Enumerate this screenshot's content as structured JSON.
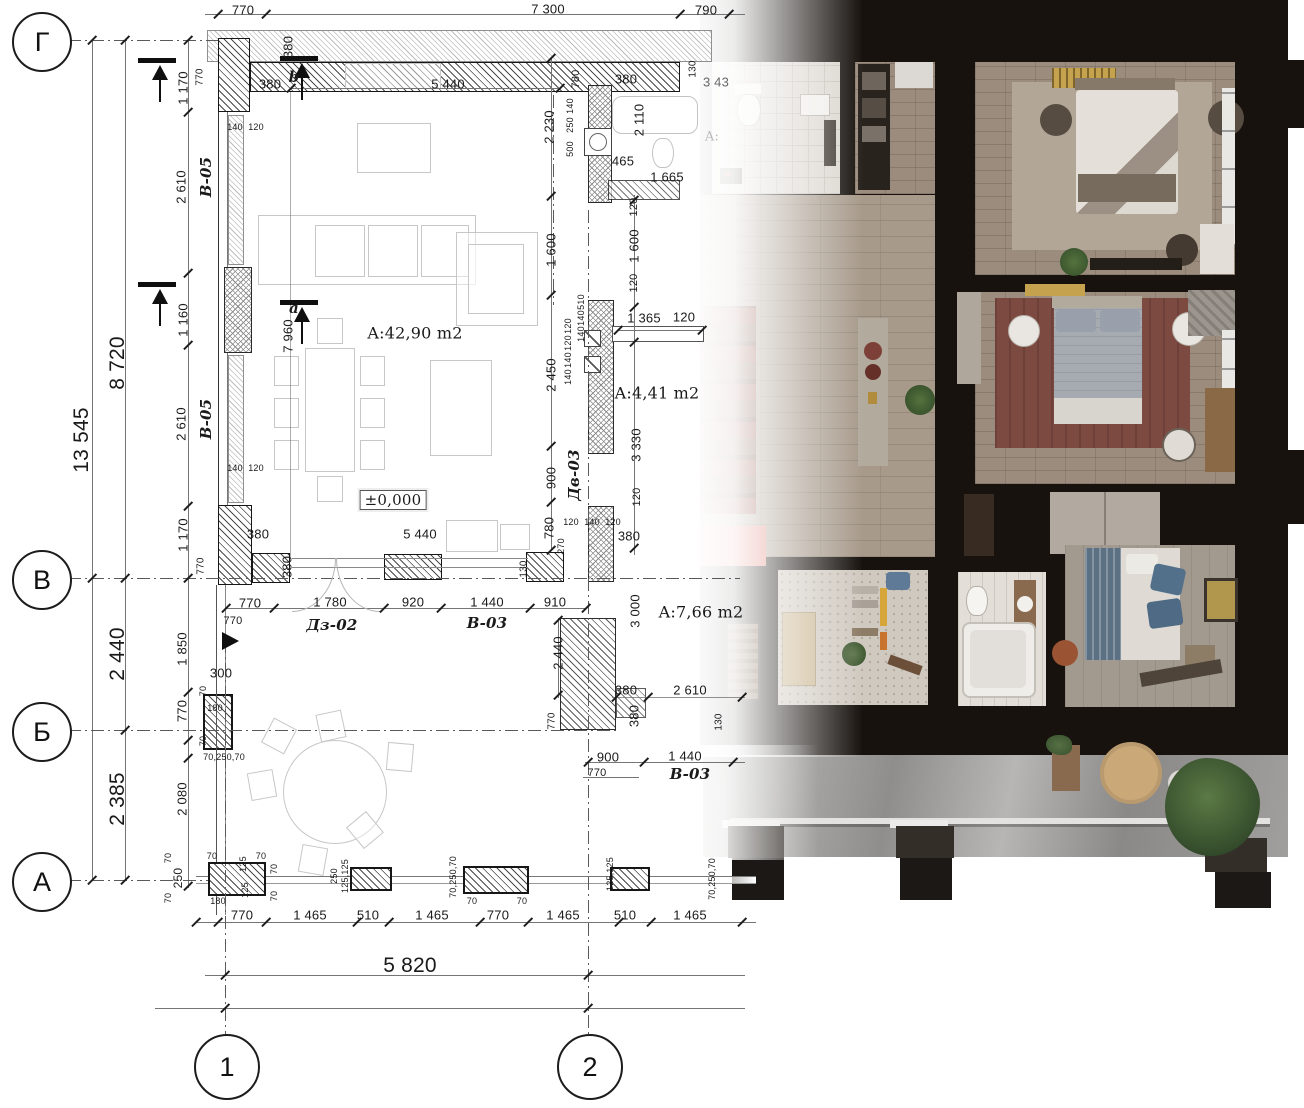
{
  "axes": {
    "rows": [
      {
        "label": "Г"
      },
      {
        "label": "В"
      },
      {
        "label": "Б"
      },
      {
        "label": "А"
      }
    ],
    "cols": [
      {
        "label": "1"
      },
      {
        "label": "2"
      }
    ]
  },
  "palette": {
    "wall_black": "#17120e",
    "wood_floor": "#9b8c7d",
    "hall_floor": "#a79a8b",
    "rug_red": "#7c4a41",
    "cabinet_red": "#df857b",
    "bed_blue": "#5c7083",
    "tile_white": "#dbd6cf",
    "terrace_concrete": "#97968f",
    "gold": "#c5a24d"
  },
  "dims": [
    {
      "t": "770",
      "x": 243,
      "y": 10
    },
    {
      "t": "7 300",
      "x": 548,
      "y": 9
    },
    {
      "t": "790",
      "x": 706,
      "y": 10
    },
    {
      "t": "770",
      "x": 200,
      "y": 77,
      "r": -90,
      "s": 10
    },
    {
      "t": "1 170",
      "x": 183,
      "y": 88,
      "r": -90
    },
    {
      "t": "380",
      "x": 270,
      "y": 84
    },
    {
      "t": "b",
      "x": 294,
      "y": 77,
      "c": "tag",
      "n": "section-mark-b"
    },
    {
      "t": "380",
      "x": 288,
      "y": 47,
      "r": -90
    },
    {
      "t": "5 440",
      "x": 448,
      "y": 84
    },
    {
      "t": "780",
      "x": 576,
      "y": 79,
      "r": -90,
      "s": 11
    },
    {
      "t": "2 230",
      "x": 549,
      "y": 127,
      "r": -90
    },
    {
      "t": "140",
      "x": 570,
      "y": 106,
      "r": -90,
      "s": 9
    },
    {
      "t": "250",
      "x": 570,
      "y": 125,
      "r": -90,
      "s": 9
    },
    {
      "t": "500",
      "x": 570,
      "y": 149,
      "r": -90,
      "s": 9
    },
    {
      "t": "380",
      "x": 626,
      "y": 79
    },
    {
      "t": "2 110",
      "x": 639,
      "y": 120,
      "r": -90
    },
    {
      "t": "130",
      "x": 693,
      "y": 69,
      "r": -90,
      "s": 10
    },
    {
      "t": "3 43",
      "x": 716,
      "y": 82,
      "c": "fade"
    },
    {
      "t": "465",
      "x": 623,
      "y": 161
    },
    {
      "t": "1 665",
      "x": 667,
      "y": 177
    },
    {
      "t": "120",
      "x": 634,
      "y": 207,
      "r": -90,
      "s": 11
    },
    {
      "t": "1 600",
      "x": 634,
      "y": 246,
      "r": -90
    },
    {
      "t": "1 600",
      "x": 551,
      "y": 250,
      "r": -90
    },
    {
      "t": "120",
      "x": 634,
      "y": 283,
      "r": -90,
      "s": 11
    },
    {
      "t": "A:",
      "x": 712,
      "y": 137,
      "c": "faint"
    },
    {
      "t": "13 545",
      "x": 82,
      "y": 440,
      "r": -90,
      "c": "big"
    },
    {
      "t": "8 720",
      "x": 118,
      "y": 363,
      "r": -90,
      "c": "big"
    },
    {
      "t": "2 440",
      "x": 118,
      "y": 654,
      "r": -90,
      "c": "big"
    },
    {
      "t": "2 385",
      "x": 118,
      "y": 799,
      "r": -90,
      "c": "big"
    },
    {
      "t": "2 610",
      "x": 181,
      "y": 187,
      "r": -90
    },
    {
      "t": "В-05",
      "x": 206,
      "y": 177,
      "r": -90,
      "c": "tag",
      "n": "tag-window-v05"
    },
    {
      "t": "140",
      "x": 235,
      "y": 127,
      "s": 9
    },
    {
      "t": "120",
      "x": 256,
      "y": 127,
      "s": 9
    },
    {
      "t": "1 160",
      "x": 183,
      "y": 320,
      "r": -90
    },
    {
      "t": "2 610",
      "x": 181,
      "y": 424,
      "r": -90
    },
    {
      "t": "В-05",
      "x": 206,
      "y": 419,
      "r": -90,
      "c": "tag",
      "n": "tag-window-v05"
    },
    {
      "t": "140",
      "x": 235,
      "y": 468,
      "s": 9
    },
    {
      "t": "120",
      "x": 256,
      "y": 468,
      "s": 9
    },
    {
      "t": "1 170",
      "x": 183,
      "y": 535,
      "r": -90
    },
    {
      "t": "770",
      "x": 201,
      "y": 566,
      "r": -90,
      "s": 10
    },
    {
      "t": "a",
      "x": 294,
      "y": 308,
      "c": "tag",
      "n": "section-mark-a"
    },
    {
      "t": "7 960",
      "x": 288,
      "y": 336,
      "r": -90
    },
    {
      "t": "A:42,90 m2",
      "x": 415,
      "y": 333,
      "c": "area",
      "n": "room-area-living"
    },
    {
      "t": "±0,000",
      "x": 393,
      "y": 500,
      "c": "box",
      "n": "level-mark"
    },
    {
      "t": "510",
      "x": 581,
      "y": 302,
      "r": -90,
      "s": 9
    },
    {
      "t": "140",
      "x": 581,
      "y": 318,
      "r": -90,
      "s": 9
    },
    {
      "t": "140",
      "x": 581,
      "y": 334,
      "r": -90,
      "s": 9
    },
    {
      "t": "120",
      "x": 568,
      "y": 326,
      "r": -90,
      "s": 9
    },
    {
      "t": "120",
      "x": 568,
      "y": 343,
      "r": -90,
      "s": 9
    },
    {
      "t": "140",
      "x": 568,
      "y": 360,
      "r": -90,
      "s": 9
    },
    {
      "t": "140",
      "x": 568,
      "y": 377,
      "r": -90,
      "s": 9
    },
    {
      "t": "1 365",
      "x": 644,
      "y": 318
    },
    {
      "t": "120",
      "x": 684,
      "y": 317
    },
    {
      "t": "2 450",
      "x": 551,
      "y": 375,
      "r": -90
    },
    {
      "t": "A:4,41 m2",
      "x": 657,
      "y": 393,
      "c": "area",
      "n": "room-area-kitchen"
    },
    {
      "t": "3 330",
      "x": 636,
      "y": 445,
      "r": -90
    },
    {
      "t": "900",
      "x": 551,
      "y": 478,
      "r": -90
    },
    {
      "t": "Дв-03",
      "x": 574,
      "y": 475,
      "r": -90,
      "c": "tag",
      "n": "tag-door-dv03"
    },
    {
      "t": "780",
      "x": 549,
      "y": 528,
      "r": -90
    },
    {
      "t": "120",
      "x": 571,
      "y": 522,
      "s": 9
    },
    {
      "t": "140",
      "x": 592,
      "y": 522,
      "s": 9
    },
    {
      "t": "120",
      "x": 613,
      "y": 522,
      "s": 9
    },
    {
      "t": "380",
      "x": 629,
      "y": 536
    },
    {
      "t": "270",
      "x": 561,
      "y": 546,
      "r": -90,
      "s": 9
    },
    {
      "t": "120",
      "x": 637,
      "y": 497,
      "r": -90,
      "s": 11
    },
    {
      "t": "3 000",
      "x": 635,
      "y": 611,
      "r": -90
    },
    {
      "t": "A:7,66 m2",
      "x": 701,
      "y": 612,
      "c": "area",
      "n": "room-area-hall"
    },
    {
      "t": "380",
      "x": 258,
      "y": 534
    },
    {
      "t": "5 440",
      "x": 420,
      "y": 534
    },
    {
      "t": "380",
      "x": 287,
      "y": 567,
      "r": -90
    },
    {
      "t": "130",
      "x": 524,
      "y": 569,
      "r": -90,
      "s": 10
    },
    {
      "t": "770",
      "x": 250,
      "y": 603
    },
    {
      "t": "1 780",
      "x": 330,
      "y": 602
    },
    {
      "t": "920",
      "x": 413,
      "y": 602
    },
    {
      "t": "1 440",
      "x": 487,
      "y": 602
    },
    {
      "t": "910",
      "x": 555,
      "y": 602
    },
    {
      "t": "770",
      "x": 233,
      "y": 621,
      "s": 11
    },
    {
      "t": "Дз-02",
      "x": 332,
      "y": 625,
      "c": "tag",
      "n": "tag-door-dz02"
    },
    {
      "t": "В-03",
      "x": 487,
      "y": 623,
      "c": "tag",
      "n": "tag-window-v03"
    },
    {
      "t": "2 440",
      "x": 558,
      "y": 653,
      "r": -90
    },
    {
      "t": "1 850",
      "x": 182,
      "y": 649,
      "r": -90
    },
    {
      "t": "300",
      "x": 221,
      "y": 673
    },
    {
      "t": "70",
      "x": 203,
      "y": 691,
      "r": -90,
      "s": 9
    },
    {
      "t": "180",
      "x": 215,
      "y": 708,
      "s": 9
    },
    {
      "t": "70",
      "x": 203,
      "y": 741,
      "r": -90,
      "s": 9
    },
    {
      "t": "770",
      "x": 182,
      "y": 711,
      "r": -90
    },
    {
      "t": "70,250,70",
      "x": 224,
      "y": 757,
      "s": 9
    },
    {
      "t": "2 080",
      "x": 182,
      "y": 799,
      "r": -90
    },
    {
      "t": "770",
      "x": 552,
      "y": 721,
      "r": -90,
      "s": 10
    },
    {
      "t": "380",
      "x": 626,
      "y": 690
    },
    {
      "t": "2 610",
      "x": 690,
      "y": 690
    },
    {
      "t": "380",
      "x": 634,
      "y": 716,
      "r": -90
    },
    {
      "t": "130",
      "x": 719,
      "y": 722,
      "r": -90,
      "s": 10
    },
    {
      "t": "900",
      "x": 608,
      "y": 757
    },
    {
      "t": "1 440",
      "x": 685,
      "y": 756
    },
    {
      "t": "770",
      "x": 597,
      "y": 773,
      "s": 11
    },
    {
      "t": "В-03",
      "x": 690,
      "y": 774,
      "c": "tag",
      "n": "tag-window-v03"
    },
    {
      "t": "70",
      "x": 168,
      "y": 858,
      "r": -90,
      "s": 9
    },
    {
      "t": "250",
      "x": 178,
      "y": 878,
      "r": -90,
      "s": 12
    },
    {
      "t": "70",
      "x": 168,
      "y": 898,
      "r": -90,
      "s": 9
    },
    {
      "t": "70",
      "x": 212,
      "y": 856,
      "s": 9
    },
    {
      "t": "125",
      "x": 243,
      "y": 864,
      "r": -90,
      "s": 9
    },
    {
      "t": "125",
      "x": 245,
      "y": 890,
      "r": -90,
      "s": 9
    },
    {
      "t": "180",
      "x": 218,
      "y": 901,
      "s": 9
    },
    {
      "t": "70",
      "x": 261,
      "y": 856,
      "s": 9
    },
    {
      "t": "70",
      "x": 274,
      "y": 869,
      "r": -90,
      "s": 9
    },
    {
      "t": "70",
      "x": 274,
      "y": 896,
      "r": -90,
      "s": 9
    },
    {
      "t": "770",
      "x": 242,
      "y": 915
    },
    {
      "t": "1 465",
      "x": 310,
      "y": 915
    },
    {
      "t": "250",
      "x": 334,
      "y": 876,
      "r": -90,
      "s": 9
    },
    {
      "t": "125,125",
      "x": 345,
      "y": 876,
      "r": -90,
      "s": 9
    },
    {
      "t": "510",
      "x": 368,
      "y": 915
    },
    {
      "t": "1 465",
      "x": 432,
      "y": 915
    },
    {
      "t": "70,250,70",
      "x": 453,
      "y": 877,
      "r": -90,
      "s": 9
    },
    {
      "t": "70",
      "x": 472,
      "y": 901,
      "s": 9
    },
    {
      "t": "770",
      "x": 498,
      "y": 915
    },
    {
      "t": "70",
      "x": 522,
      "y": 901,
      "s": 9
    },
    {
      "t": "1 465",
      "x": 563,
      "y": 915
    },
    {
      "t": "125,125",
      "x": 610,
      "y": 874,
      "r": -90,
      "s": 9
    },
    {
      "t": "510",
      "x": 625,
      "y": 915
    },
    {
      "t": "1 465",
      "x": 690,
      "y": 915
    },
    {
      "t": "70,250,70",
      "x": 712,
      "y": 879,
      "r": -90,
      "s": 9
    },
    {
      "t": "5 820",
      "x": 410,
      "y": 966,
      "c": "big"
    }
  ]
}
